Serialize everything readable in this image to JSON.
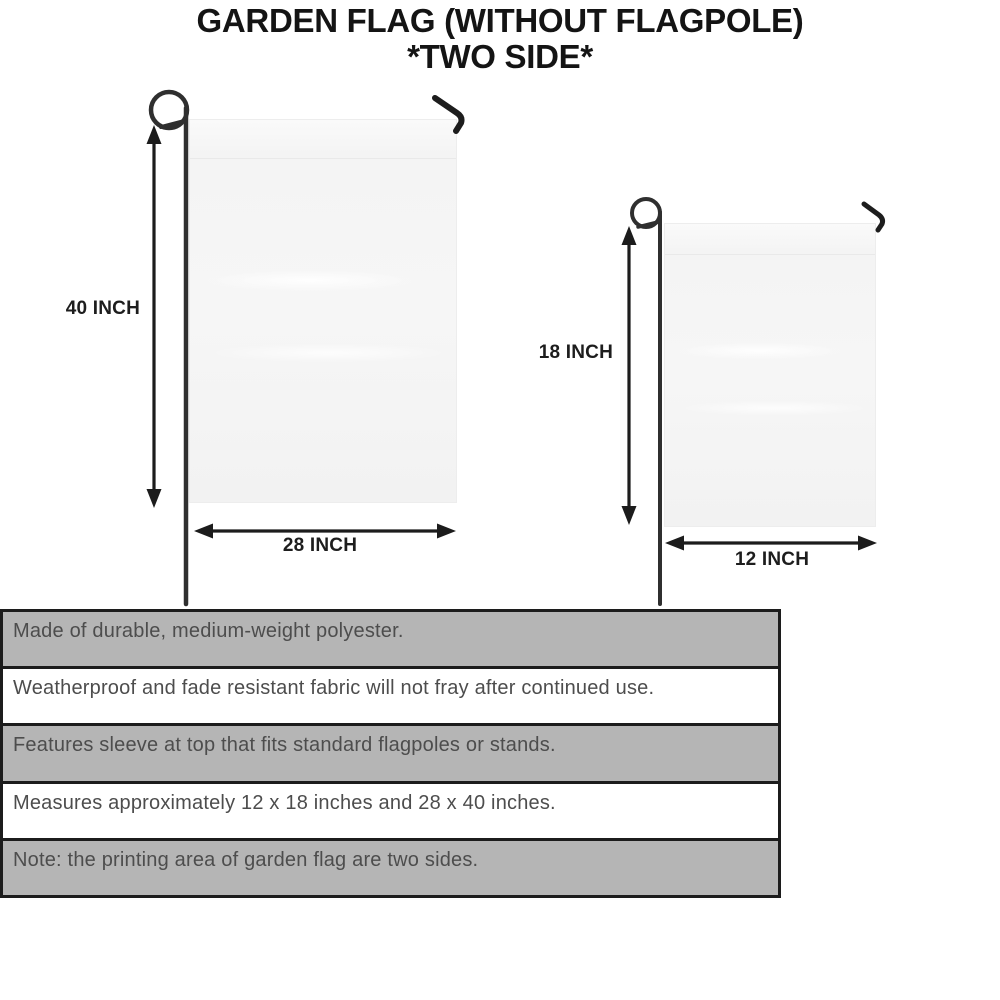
{
  "title": {
    "line1": "GARDEN FLAG (WITHOUT FLAGPOLE)",
    "line2": "*TWO SIDE*"
  },
  "diagram": {
    "large_flag": {
      "height_label": "40 INCH",
      "width_label": "28 INCH"
    },
    "small_flag": {
      "height_label": "18 INCH",
      "width_label": "12 INCH"
    }
  },
  "features": [
    "Made of durable, medium-weight polyester.",
    "Weatherproof and fade resistant fabric will not fray after continued use.",
    "Features sleeve at top that fits standard flagpoles or stands.",
    "Measures approximately 12 x 18 inches and 28 x 40 inches.",
    "Note: the printing area of garden flag are two sides."
  ],
  "colors": {
    "row_gray": "#b5b5b5",
    "row_white": "#ffffff",
    "table_border": "#1c1c1c",
    "title_text": "#141414",
    "feature_text": "#4d4d4d",
    "pole": "#2f2f2f",
    "arrow": "#1c1c1c",
    "flag_fill": "#f5f5f5"
  }
}
